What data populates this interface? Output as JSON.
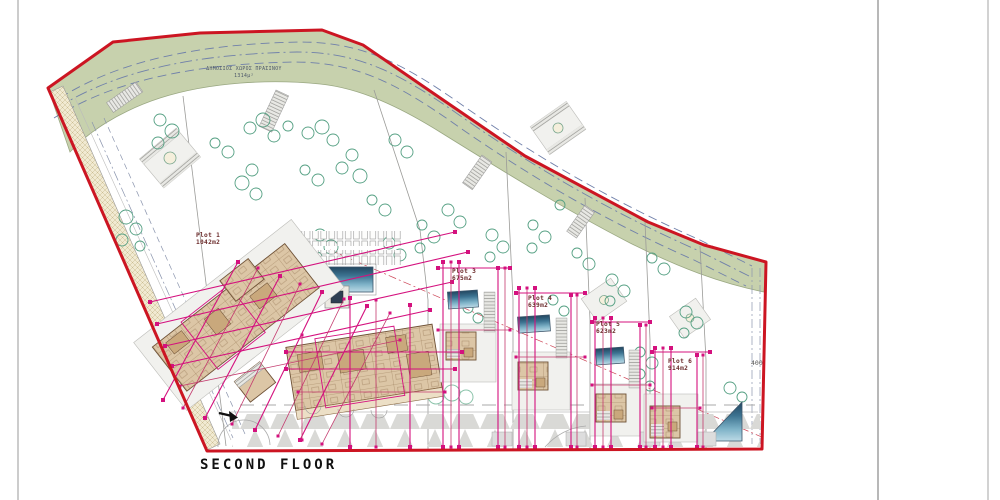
{
  "page": {
    "floor_title": "SECOND FLOOR"
  },
  "green_space": {
    "label": "ΔΗΜΟΣΙΟΣ ΧΩΡΟΣ ΠΡΑΣΙΝΟΥ",
    "area": "1314μ²"
  },
  "plots": [
    {
      "name": "Plot 1",
      "area": "1042m2"
    },
    {
      "name": "Plot 3",
      "area": "675m2"
    },
    {
      "name": "Plot 4",
      "area": "639m2"
    },
    {
      "name": "Plot 5",
      "area": "623m2"
    },
    {
      "name": "Plot 6",
      "area": "914m2"
    }
  ],
  "annotations": {
    "road_width": "400"
  },
  "colors": {
    "boundary_red": "#cc1522",
    "green_space": "#c7d1ad",
    "dimension_magenta": "#d4117e",
    "pool_blue": "#27506e",
    "building_tan": "#dcc6a6"
  }
}
